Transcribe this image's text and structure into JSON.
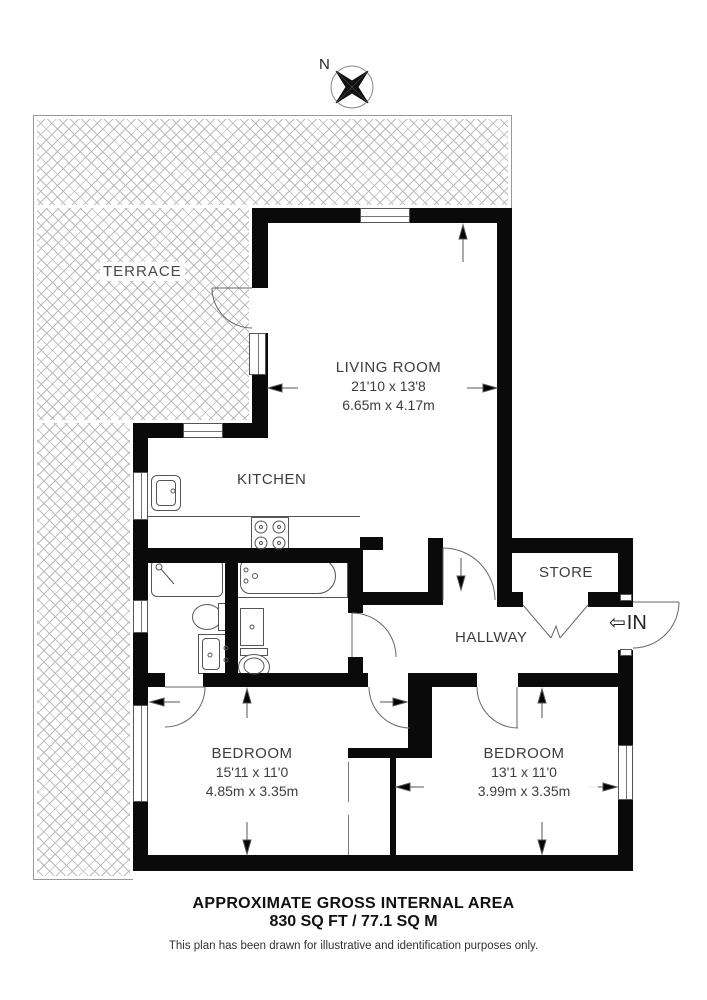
{
  "compass": {
    "north_label": "N"
  },
  "rooms": {
    "terrace": {
      "name": "TERRACE"
    },
    "living": {
      "name": "LIVING ROOM",
      "imperial": "21'10 x 13'8",
      "metric": "6.65m x 4.17m"
    },
    "kitchen": {
      "name": "KITCHEN"
    },
    "store": {
      "name": "STORE"
    },
    "hallway": {
      "name": "HALLWAY"
    },
    "bedroom_left": {
      "name": "BEDROOM",
      "imperial": "15'11 x 11'0",
      "metric": "4.85m x 3.35m"
    },
    "bedroom_right": {
      "name": "BEDROOM",
      "imperial": "13'1 x 11'0",
      "metric": "3.99m x 3.35m"
    }
  },
  "entrance": {
    "label": "IN",
    "arrow": "⇦"
  },
  "footer": {
    "title": "APPROXIMATE GROSS INTERNAL AREA",
    "area": "830 SQ FT / 77.1 SQ M",
    "disclaimer": "This plan has been drawn for illustrative and identification purposes only."
  },
  "colors": {
    "wall": "#0a0a0a",
    "hatch_line": "#bcbcbc",
    "text": "#3d3d3d"
  }
}
